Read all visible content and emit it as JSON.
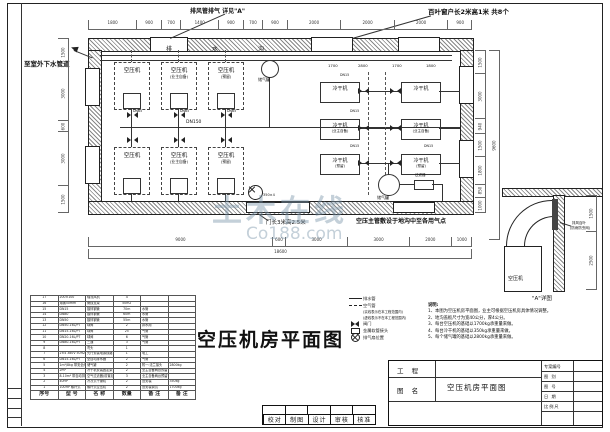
{
  "title": "空压机房平面图",
  "watermark": {
    "cn": "土木在线",
    "en": "Co188.com"
  },
  "annotations": {
    "exhaust_note": "排风管排气 详见\"A\"",
    "louver_note": "百叶窗户长2米高1米  共8个",
    "drain_note": "至室外下水管道",
    "door_note": "门长3米高2.5米",
    "main_pipe_note": "空压主管敷设于地沟中至各用气点"
  },
  "plan": {
    "trench": [
      "排",
      "水",
      "沟"
    ],
    "compressors": [
      {
        "label": "空压机",
        "sub": ""
      },
      {
        "label": "空压机",
        "sub": "(业主自备)"
      },
      {
        "label": "空压机",
        "sub": "(预留)"
      },
      {
        "label": "空压机",
        "sub": ""
      },
      {
        "label": "空压机",
        "sub": "(业主自备)"
      },
      {
        "label": "空压机",
        "sub": "(预留)"
      }
    ],
    "dryers": [
      {
        "label": "冷干机",
        "sub": ""
      },
      {
        "label": "冷干机",
        "sub": ""
      },
      {
        "label": "冷干机",
        "sub": "(业主自备)"
      },
      {
        "label": "冷干机",
        "sub": "(业主自备)"
      },
      {
        "label": "冷干机",
        "sub": "(预留)"
      },
      {
        "label": "冷干机",
        "sub": "(预留)"
      }
    ],
    "tanks": [
      "储气罐",
      "储气罐"
    ],
    "filter_label": "过滤器",
    "fan_label": "350×4",
    "pipe_labels": {
      "main": "DN150",
      "branch": "DN65",
      "small": "DN15"
    },
    "inner_dims": [
      "1700",
      "2800",
      "1700",
      "1800"
    ]
  },
  "dims": {
    "top": [
      "1800",
      "900",
      "700",
      "1400",
      "900",
      "700",
      "900",
      "2000",
      "2000",
      "2000",
      "900"
    ],
    "bottom": [
      "9000",
      "600",
      "3000",
      "3000",
      "2000",
      "1000"
    ],
    "bottom_total": "18600",
    "left": [
      "1500",
      "3000",
      "600",
      "3000",
      "1500"
    ],
    "right": [
      "1500",
      "3000",
      "940",
      "1500",
      "1800",
      "850",
      "1000"
    ],
    "right_total": "9600",
    "detail": [
      "1500",
      "2500"
    ]
  },
  "legend": {
    "items": [
      {
        "label": "排水管"
      },
      {
        "label": "空气管"
      },
      {
        "label": "(实线表示在本工程范围内)"
      },
      {
        "label": "(虚线表示不在本工程范围内)"
      },
      {
        "label": "阀门"
      },
      {
        "label": "金属软管接头"
      },
      {
        "label": "排气扇位置"
      }
    ]
  },
  "notes": {
    "heading": "说明:",
    "items": [
      "1、本图为空压机房平面图，业主可根据空压机房具体情况调整。",
      "2、地沟盖板尺寸为宽40公分，厚4公分。",
      "3、每台空压机的基础以1700kg承重量来做。",
      "4、每台冷干机的基础以350kg承重量来做。",
      "5、每个储气罐的基础以2800kg承重量来做。"
    ]
  },
  "detail": {
    "caption": "\"A\"详图",
    "machine": "空压机",
    "louver_line1": "排风百叶",
    "louver_line2": "(防雨防虫网)"
  },
  "bom": {
    "headers": [
      "序号",
      "型  号",
      "名  称",
      "数量",
      "备 注",
      "备 注"
    ],
    "rows": [
      [
        "17",
        "200×100",
        "轴流风机",
        "4",
        "",
        ""
      ],
      [
        "16",
        "角钢50mm",
        "管线支架",
        "50m2",
        "",
        ""
      ],
      [
        "15",
        "DN15",
        "镀锌钢管",
        "70m",
        "水管",
        ""
      ],
      [
        "14",
        "DN80",
        "镀锌钢管",
        "60m",
        "水管",
        ""
      ],
      [
        "13",
        "DN50",
        "镀锌钢管",
        "55m",
        "水管",
        ""
      ],
      [
        "12",
        "DN50-16L/PT",
        "球阀",
        "2",
        "排水用",
        ""
      ],
      [
        "11",
        "DN15-16L/PT",
        "球阀",
        "25",
        "气管",
        ""
      ],
      [
        "10",
        "DN20-16L/PT",
        "球阀",
        "6",
        "气管",
        ""
      ],
      [
        "9",
        "DN80-16L/PT",
        "三通",
        "3",
        "气管",
        ""
      ],
      [
        "8",
        "",
        "弯头",
        "1",
        "",
        ""
      ],
      [
        "7",
        "2×4 380V 50HZ",
        "先行安装电源线路",
        "1",
        "电工",
        ""
      ],
      [
        "6",
        "DN15-16L/PT",
        "全自动排水器",
        "2",
        "气管",
        ""
      ],
      [
        "5",
        "1m³/8kg 带安全阀压力表",
        "储气罐",
        "2",
        "附一:法兰接头",
        "2800kg"
      ],
      [
        "4",
        "2m³",
        "冷干机安装固定架",
        "2",
        "业主自备两台预留",
        ""
      ],
      [
        "3",
        "8-10m³ 带自动排水",
        "空气过滤器(前置后置)",
        "3",
        "业主自备两台预留",
        ""
      ],
      [
        "2",
        "40HP",
        "冷冻式干燥机",
        "2",
        "含安装",
        "350kg"
      ],
      [
        "1",
        "100HP 螺杆式",
        "螺杆式空压机",
        "2",
        "含安装调试",
        "1700kg"
      ]
    ]
  },
  "approval": {
    "labels": [
      "校对",
      "制图",
      "设计",
      "审核",
      "核准"
    ]
  },
  "titleblock": {
    "project_label": "工  程",
    "project_value": "",
    "name_label": "图  名",
    "name_value": "空压机房平面图",
    "fields": [
      {
        "label": "专案编号",
        "value": ""
      },
      {
        "label": "图  别",
        "value": ""
      },
      {
        "label": "图  号",
        "value": ""
      },
      {
        "label": "日  期",
        "value": ""
      },
      {
        "label": "比例尺",
        "value": ""
      }
    ]
  }
}
